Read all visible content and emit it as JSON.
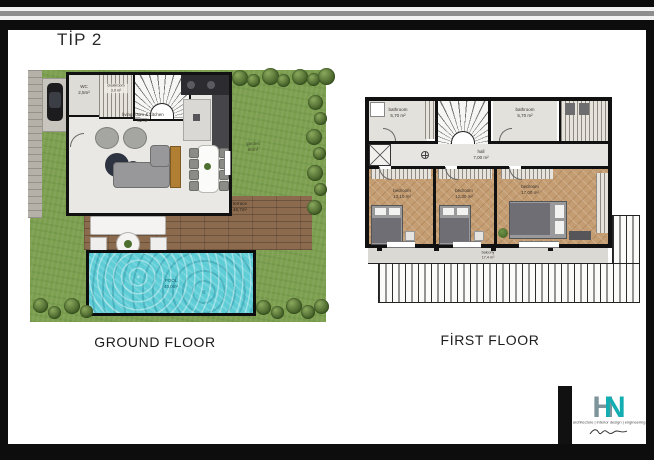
{
  "title": "TİP 2",
  "gf": {
    "caption": "GROUND FLOOR",
    "wc": {
      "name": "WC",
      "area": "2,5m²"
    },
    "cloakroom": {
      "name": "cloakroom",
      "area": "3,0 m²"
    },
    "living": {
      "name": "living room & kitchen",
      "area": "42 m²"
    },
    "garden": {
      "name": "garden",
      "area": "60m²"
    },
    "terrace": {
      "name": "terrace",
      "area": "48,7m²"
    },
    "pool": {
      "name": "POOL",
      "area": "40,0m²"
    }
  },
  "ff": {
    "caption": "FİRST FLOOR",
    "bath_l": {
      "name": "bathroom",
      "area": "5,70 m²"
    },
    "bath_r": {
      "name": "bathroom",
      "area": "5,70 m²"
    },
    "hall": {
      "name": "hall",
      "area": "7,00 m²"
    },
    "bed_l": {
      "name": "bedroom",
      "area": "13,10 m²"
    },
    "bed_m": {
      "name": "bedroom",
      "area": "12,30 m²"
    },
    "bed_r": {
      "name": "bedroom",
      "area": "17,00 m²"
    },
    "balcony": {
      "name": "balcony",
      "area": "17,4 m²"
    }
  },
  "logo": {
    "monogram_h": "H",
    "monogram_n": "N",
    "tagline": "architecture | interior design | engineering"
  },
  "colors": {
    "garden_green": "#7d9f50",
    "pool_water": "#5ecdd6",
    "deck_wood": "#8b6a4e",
    "bedroom_wood": "#c49d72",
    "logo_teal": "#14adb2",
    "logo_slate": "#7d949b"
  }
}
